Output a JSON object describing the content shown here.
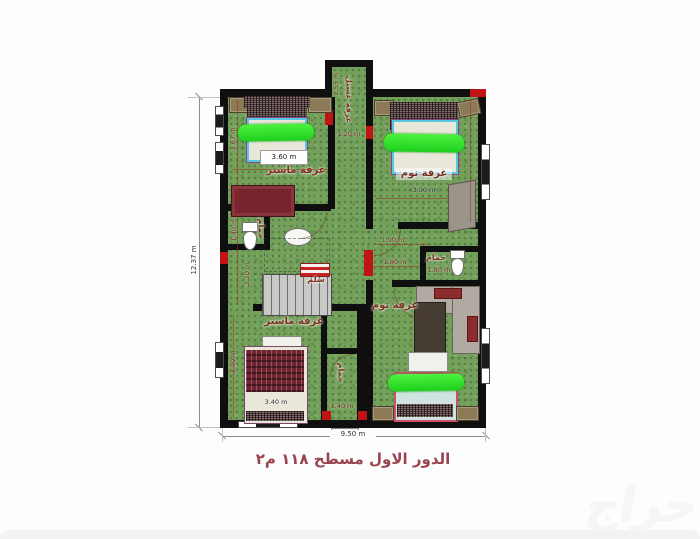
{
  "caption": "الدور الاول مسطح ١١٨ م٢",
  "watermark": "حراج",
  "overall": {
    "height": "12.37 m",
    "width": "9.50 m"
  },
  "colors": {
    "floor_green": "#73a15c",
    "wall_black": "#0f0f0f",
    "accent_red": "#c01414",
    "highlight_green": "#2ce22c",
    "label_brown": "#7b2f1f",
    "caption_red": "#98454f"
  },
  "rooms": {
    "laundry": {
      "label": "غرفة غسيل",
      "height": "2.55 m",
      "width": "1.20 m"
    },
    "master_top": {
      "label": "غرفة ماستر",
      "bed_width": "3.60 m",
      "height": "3.67 m"
    },
    "bedroom_top": {
      "label": "غرفة نوم",
      "width": "3.90 m"
    },
    "master_bottom": {
      "label": "غرفة ماستر",
      "bed_width": "3.40 m",
      "height": "3.90 m"
    },
    "bedroom_bottom": {
      "label": "غرفة نوم"
    },
    "stairs": {
      "label": "سلم",
      "height": "2.20 m"
    },
    "wc": {
      "label": "حمام",
      "height": "1.40 m"
    },
    "bath_right": {
      "label": "حمام",
      "width": "1.80 m"
    },
    "bath_bottom": {
      "label": "حمام",
      "width": "1.40 m"
    },
    "hall": {
      "dim_a": "1.90 m",
      "dim_b": "1.80 m"
    }
  }
}
